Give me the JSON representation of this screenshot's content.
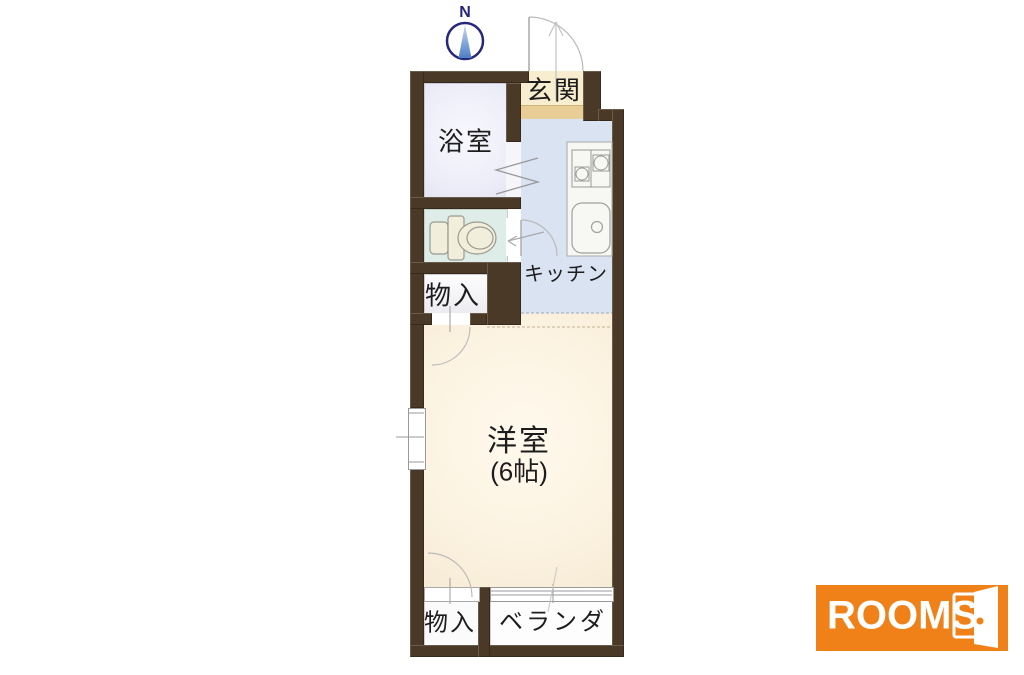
{
  "floorplan": {
    "compass": {
      "label": "N"
    },
    "rooms": {
      "bathroom": {
        "label": "浴室"
      },
      "entrance": {
        "label": "玄関"
      },
      "kitchen": {
        "label": "キッチン"
      },
      "storage_upper": {
        "label": "物入"
      },
      "western_room": {
        "label": "洋室",
        "size": "(6帖)"
      },
      "storage_lower": {
        "label": "物入"
      },
      "veranda": {
        "label": "ベランダ"
      }
    },
    "colors": {
      "wall": "#4a3927",
      "bathroom_floor": "#edeef8",
      "toilet_floor": "#dfede8",
      "kitchen_floor": "#dae3f2",
      "room_floor": "#fbf1e0",
      "entrance_floor": "#f8edcf",
      "entrance_step": "#e8cd96",
      "compass_blue": "#26267d"
    }
  },
  "logo": {
    "text": "ROOMS",
    "background": "#f08119"
  }
}
